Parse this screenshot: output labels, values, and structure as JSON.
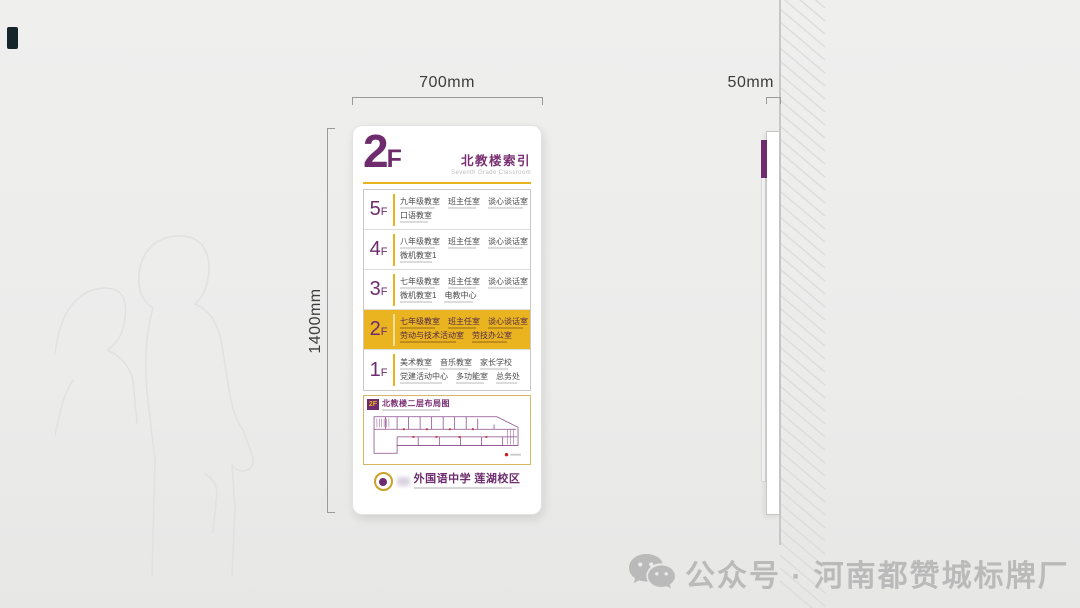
{
  "dimensions": {
    "width_label": "700mm",
    "height_label": "1400mm",
    "depth_label": "50mm"
  },
  "sign": {
    "floor_big": "2",
    "floor_suffix": "F",
    "title": "北教楼索引",
    "subtitle": "Seventh Grade Classroom",
    "rows": [
      {
        "floor": "5",
        "suffix": "F",
        "highlight": false,
        "line1": [
          "九年级教室",
          "班主任室",
          "谈心谈话室"
        ],
        "line2": [
          "口语教室"
        ]
      },
      {
        "floor": "4",
        "suffix": "F",
        "highlight": false,
        "line1": [
          "八年级教室",
          "班主任室",
          "谈心谈话室"
        ],
        "line2": [
          "微机教室1"
        ]
      },
      {
        "floor": "3",
        "suffix": "F",
        "highlight": false,
        "line1": [
          "七年级教室",
          "班主任室",
          "谈心谈话室"
        ],
        "line2": [
          "微机教室1",
          "电教中心"
        ]
      },
      {
        "floor": "2",
        "suffix": "F",
        "highlight": true,
        "line1": [
          "七年级教室",
          "班主任室",
          "谈心谈话室"
        ],
        "line2": [
          "劳动与技术活动室",
          "劳技办公室"
        ]
      },
      {
        "floor": "1",
        "suffix": "F",
        "highlight": false,
        "line1": [
          "美术教室",
          "音乐教室",
          "家长学校"
        ],
        "line2": [
          "党建活动中心",
          "多功能室",
          "总务处"
        ]
      }
    ],
    "plan": {
      "badge": "2F",
      "title": "北教楼二层布局图"
    },
    "logo_text": "外国语中学 莲湖校区"
  },
  "watermark": {
    "label": "公众号 · 河南都赞城标牌厂"
  },
  "colors": {
    "purple": "#6e2b6e",
    "gold": "#e8b41e",
    "highlight_row": "#e9b41f",
    "watermark_gray": "#b7b7b7"
  }
}
